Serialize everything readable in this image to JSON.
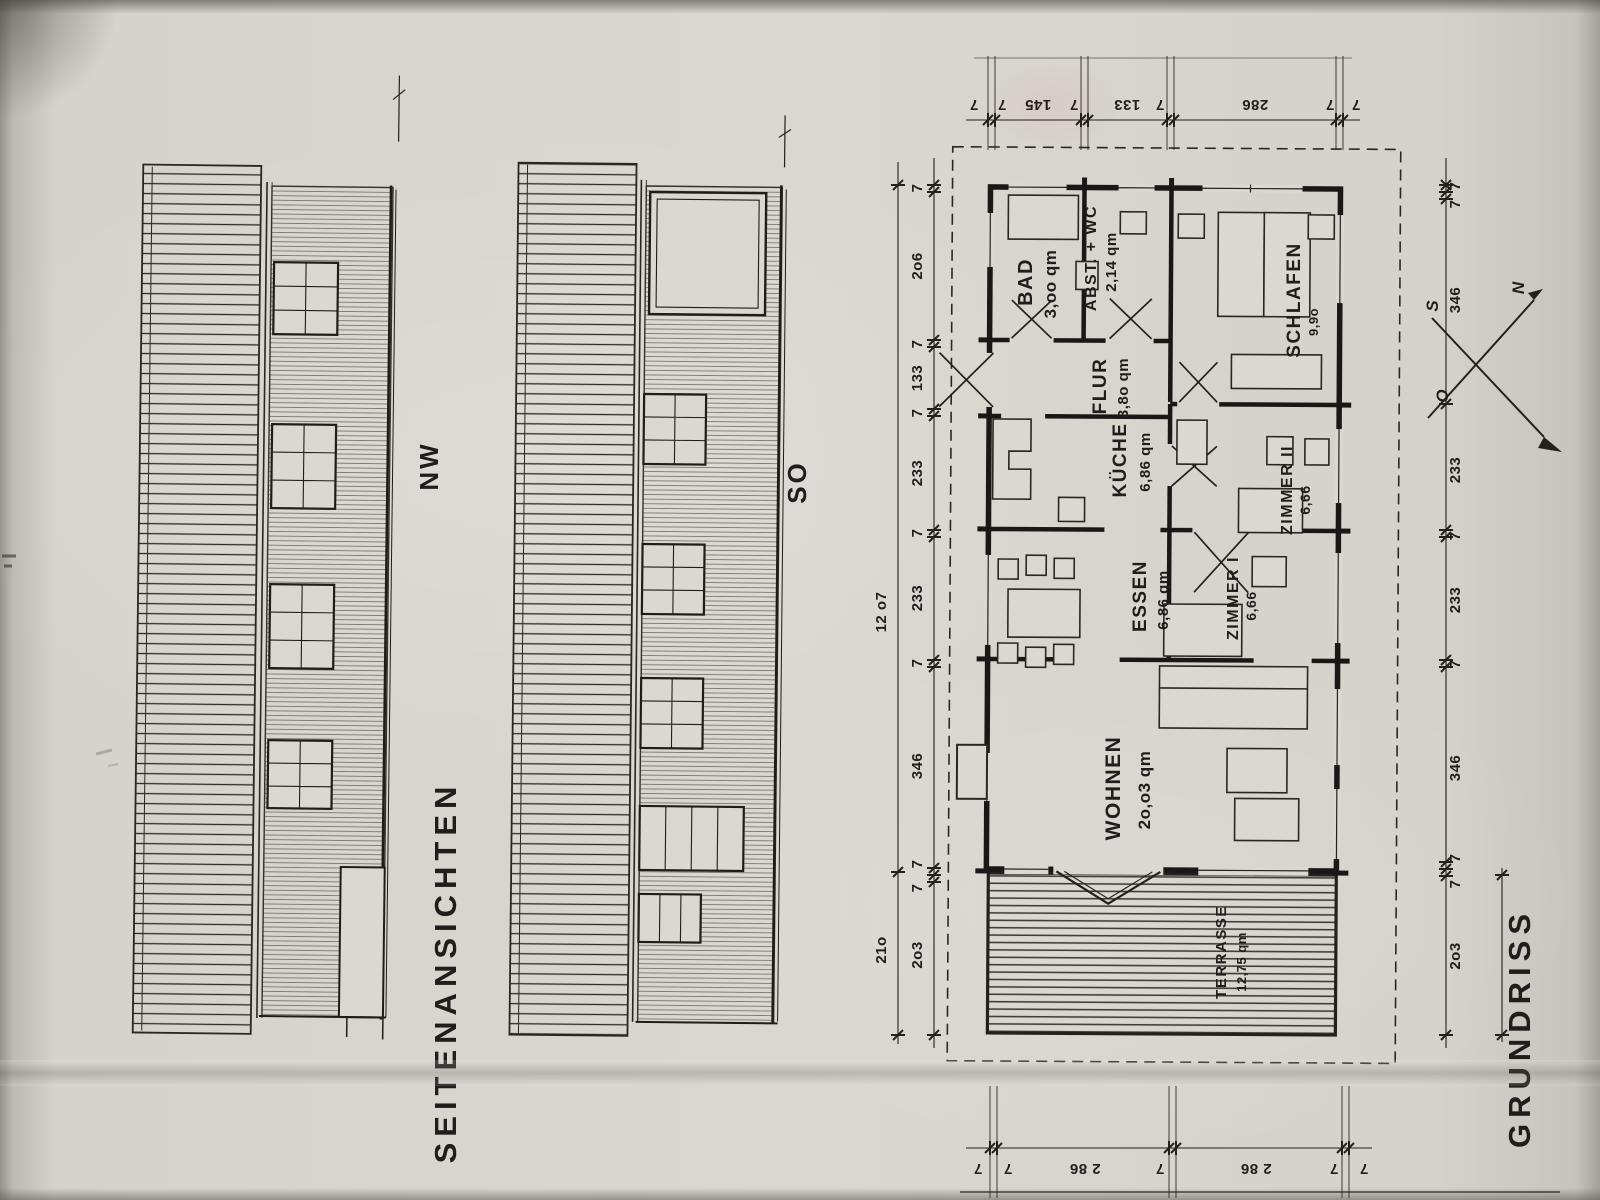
{
  "titles": {
    "elevations": "SEITENANSICHTEN",
    "plan": "GRUNDRISS"
  },
  "elevations": {
    "nw": "NW",
    "so": "SO"
  },
  "rooms": [
    {
      "name": "BAD",
      "area": "3,oo qm"
    },
    {
      "name": "ABST. + WC",
      "area": "2,14 qm"
    },
    {
      "name": "SCHLAFEN",
      "area": "9,9o"
    },
    {
      "name": "FLUR",
      "area": "3,8o qm"
    },
    {
      "name": "KÜCHE",
      "area": "6,86 qm"
    },
    {
      "name": "ZIMMER II",
      "area": "6,66"
    },
    {
      "name": "ESSEN",
      "area": "6,86 qm"
    },
    {
      "name": "ZIMMER I",
      "area": "6,66"
    },
    {
      "name": "WOHNEN",
      "area": "2o,o3 qm"
    },
    {
      "name": "TERRASSE",
      "area": "12,75 qm"
    }
  ],
  "compass": {
    "n": "N",
    "s": "S",
    "o": "O"
  },
  "dims": {
    "left_outer_total": "12 o7",
    "left_outer_terrace": "21o",
    "left_chain": [
      "7",
      "2o6",
      "7",
      "133",
      "7",
      "233",
      "7",
      "233",
      "7",
      "346",
      "7",
      "7",
      "2o3"
    ],
    "right_chain": [
      "7",
      "7",
      "346",
      "233",
      "7",
      "233",
      "7",
      "346",
      "7",
      "7",
      "2o3"
    ],
    "top_chain": [
      "7",
      "7",
      "145",
      "7",
      "133",
      "7",
      "286",
      "7",
      "7"
    ],
    "bottom_chain": [
      "7",
      "7",
      "2 86",
      "7",
      "2 86",
      "7",
      "7"
    ]
  },
  "colors": {
    "ink": "#24211d",
    "paper": "#d8d4ce"
  }
}
